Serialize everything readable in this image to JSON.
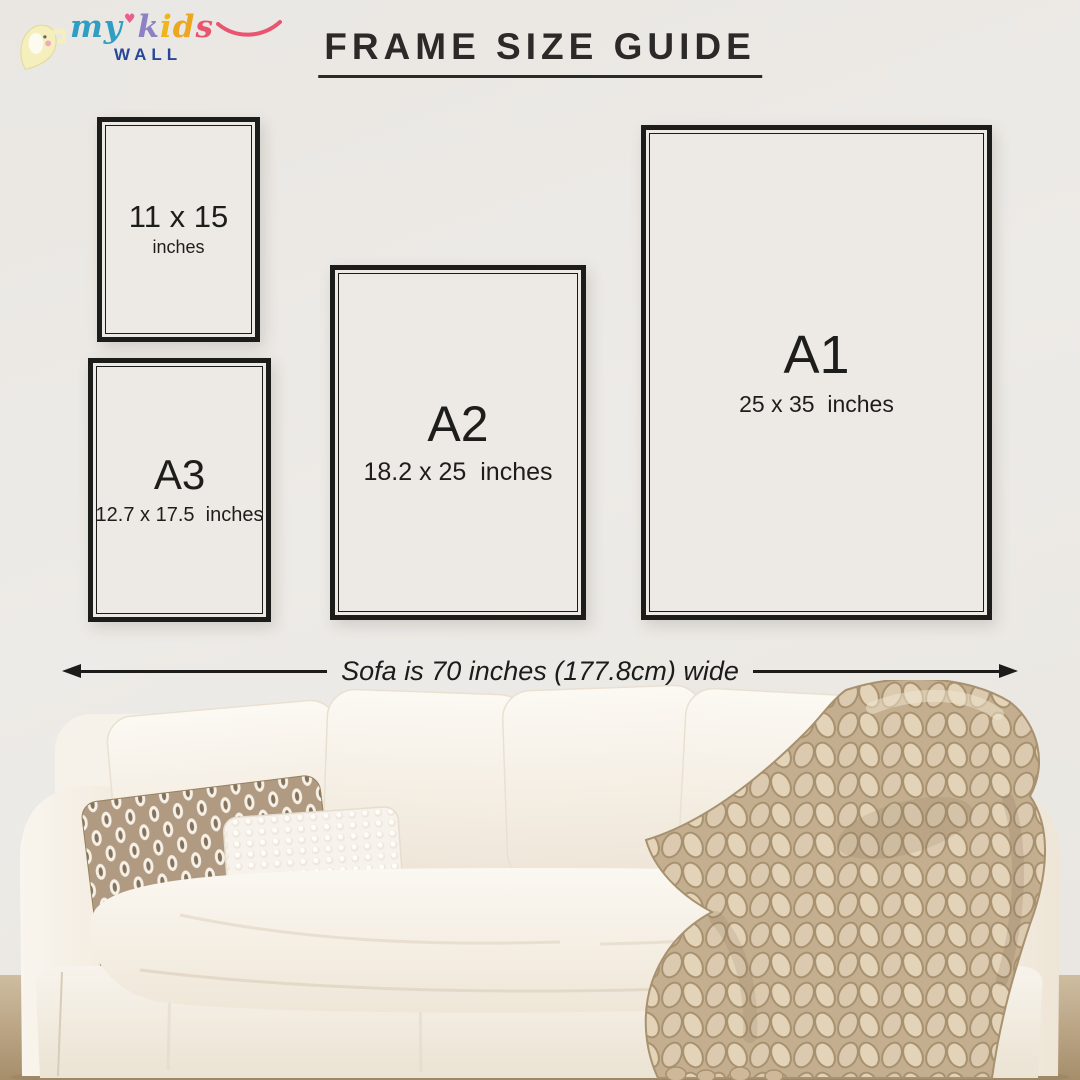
{
  "brand": {
    "my": "my",
    "heart": "♥",
    "k": "k",
    "i": "i",
    "d": "d",
    "s": "s",
    "wall": "WALL",
    "colors": {
      "my": "#2f9ec2",
      "heart": "#e85f8e",
      "k": "#8d80c5",
      "i": "#f0b41c",
      "d": "#eda620",
      "s": "#e9556f",
      "wall": "#27479a"
    }
  },
  "title": "FRAME SIZE GUIDE",
  "frames": [
    {
      "label": "11 x 15",
      "sublabel": "inches"
    },
    {
      "label": "A3",
      "sublabel": "12.7 x 17.5  inches"
    },
    {
      "label": "A2",
      "sublabel": "18.2 x 25  inches"
    },
    {
      "label": "A1",
      "sublabel": "25 x 35  inches"
    }
  ],
  "dimension_note": "Sofa is 70 inches (177.8cm) wide",
  "colors": {
    "wall": "#ebe8e4",
    "frame_border": "#1c1c1a",
    "text": "#1d1d1b",
    "floor": "#c7b499",
    "sofa_fabric": "#f8f4ed",
    "blanket": "#d5c3a9",
    "pillow_taupe": "#b09b82"
  }
}
